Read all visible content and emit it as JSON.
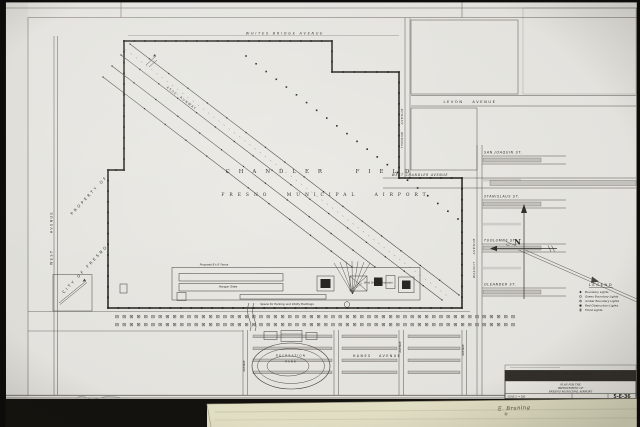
{
  "streets": {
    "whites_bridge": "WHITES BRIDGE AVENUE",
    "west": "WEST AVENUE",
    "thorne": "THORNE AVENUE",
    "levon": "LEVON AVENUE",
    "walnut": "WALNUT AVENUE",
    "west_chandler": "WEST CHANDLER AVENUE",
    "san_joaquin": "SAN JOAQUIN ST.",
    "stanislaus": "STANISLAUS ST.",
    "tuolumne": "TUOLUMNE ST.",
    "oleander": "OLEANDER ST.",
    "hanes": "HANES AVENUE",
    "avenue": "AVENUE"
  },
  "field": {
    "name": "CHANDLER FIELD",
    "subtitle": "FRESNO MUNICIPAL AIRPORT",
    "property_line1": "PROPERTY OF",
    "property_line2": "CITY OF FRESNO",
    "runway": "4500' RUNWAY"
  },
  "facilities": {
    "fence": "Proposed 8'x 8' Fence",
    "hangars": "Hangar Sites",
    "parking": "Space for Parking and Utility Buildings",
    "wind_indicator": "Wind Direction Indicator",
    "park_line1": "RECREATION",
    "park_line2": "PARK"
  },
  "compass": {
    "north": "N"
  },
  "legend": {
    "title": "LEGEND",
    "items": [
      {
        "symbol": "filled-dot",
        "label": "Boundary Lights"
      },
      {
        "symbol": "open-circle",
        "label": "Green Boundary Lights"
      },
      {
        "symbol": "circle-dot",
        "label": "Amber Boundary Lights"
      },
      {
        "symbol": "filled-square",
        "label": "Red Obstruction Lights"
      },
      {
        "symbol": "star",
        "label": "Flood Lights"
      }
    ]
  },
  "title_block": {
    "agency": "CITY OF FRESNO",
    "department": "DEPT. OF PUBLIC WORKS",
    "title_line1": "PLAN FOR THE",
    "title_line2": "IMPROVEMENT OF",
    "title_line3": "FRESNO MUNICIPAL AIRPORT",
    "scale": "SCALE 1\" = 200'",
    "sheet_number": "5-E-36"
  },
  "annotations": {
    "signature": "E. Bruning"
  },
  "colors": {
    "paper": "#eae9e4",
    "ink": "#2c2a25",
    "street_shading": "#c6c4bf",
    "folder_tan": "#e7e4c9",
    "photo_edge": "#14120e"
  }
}
